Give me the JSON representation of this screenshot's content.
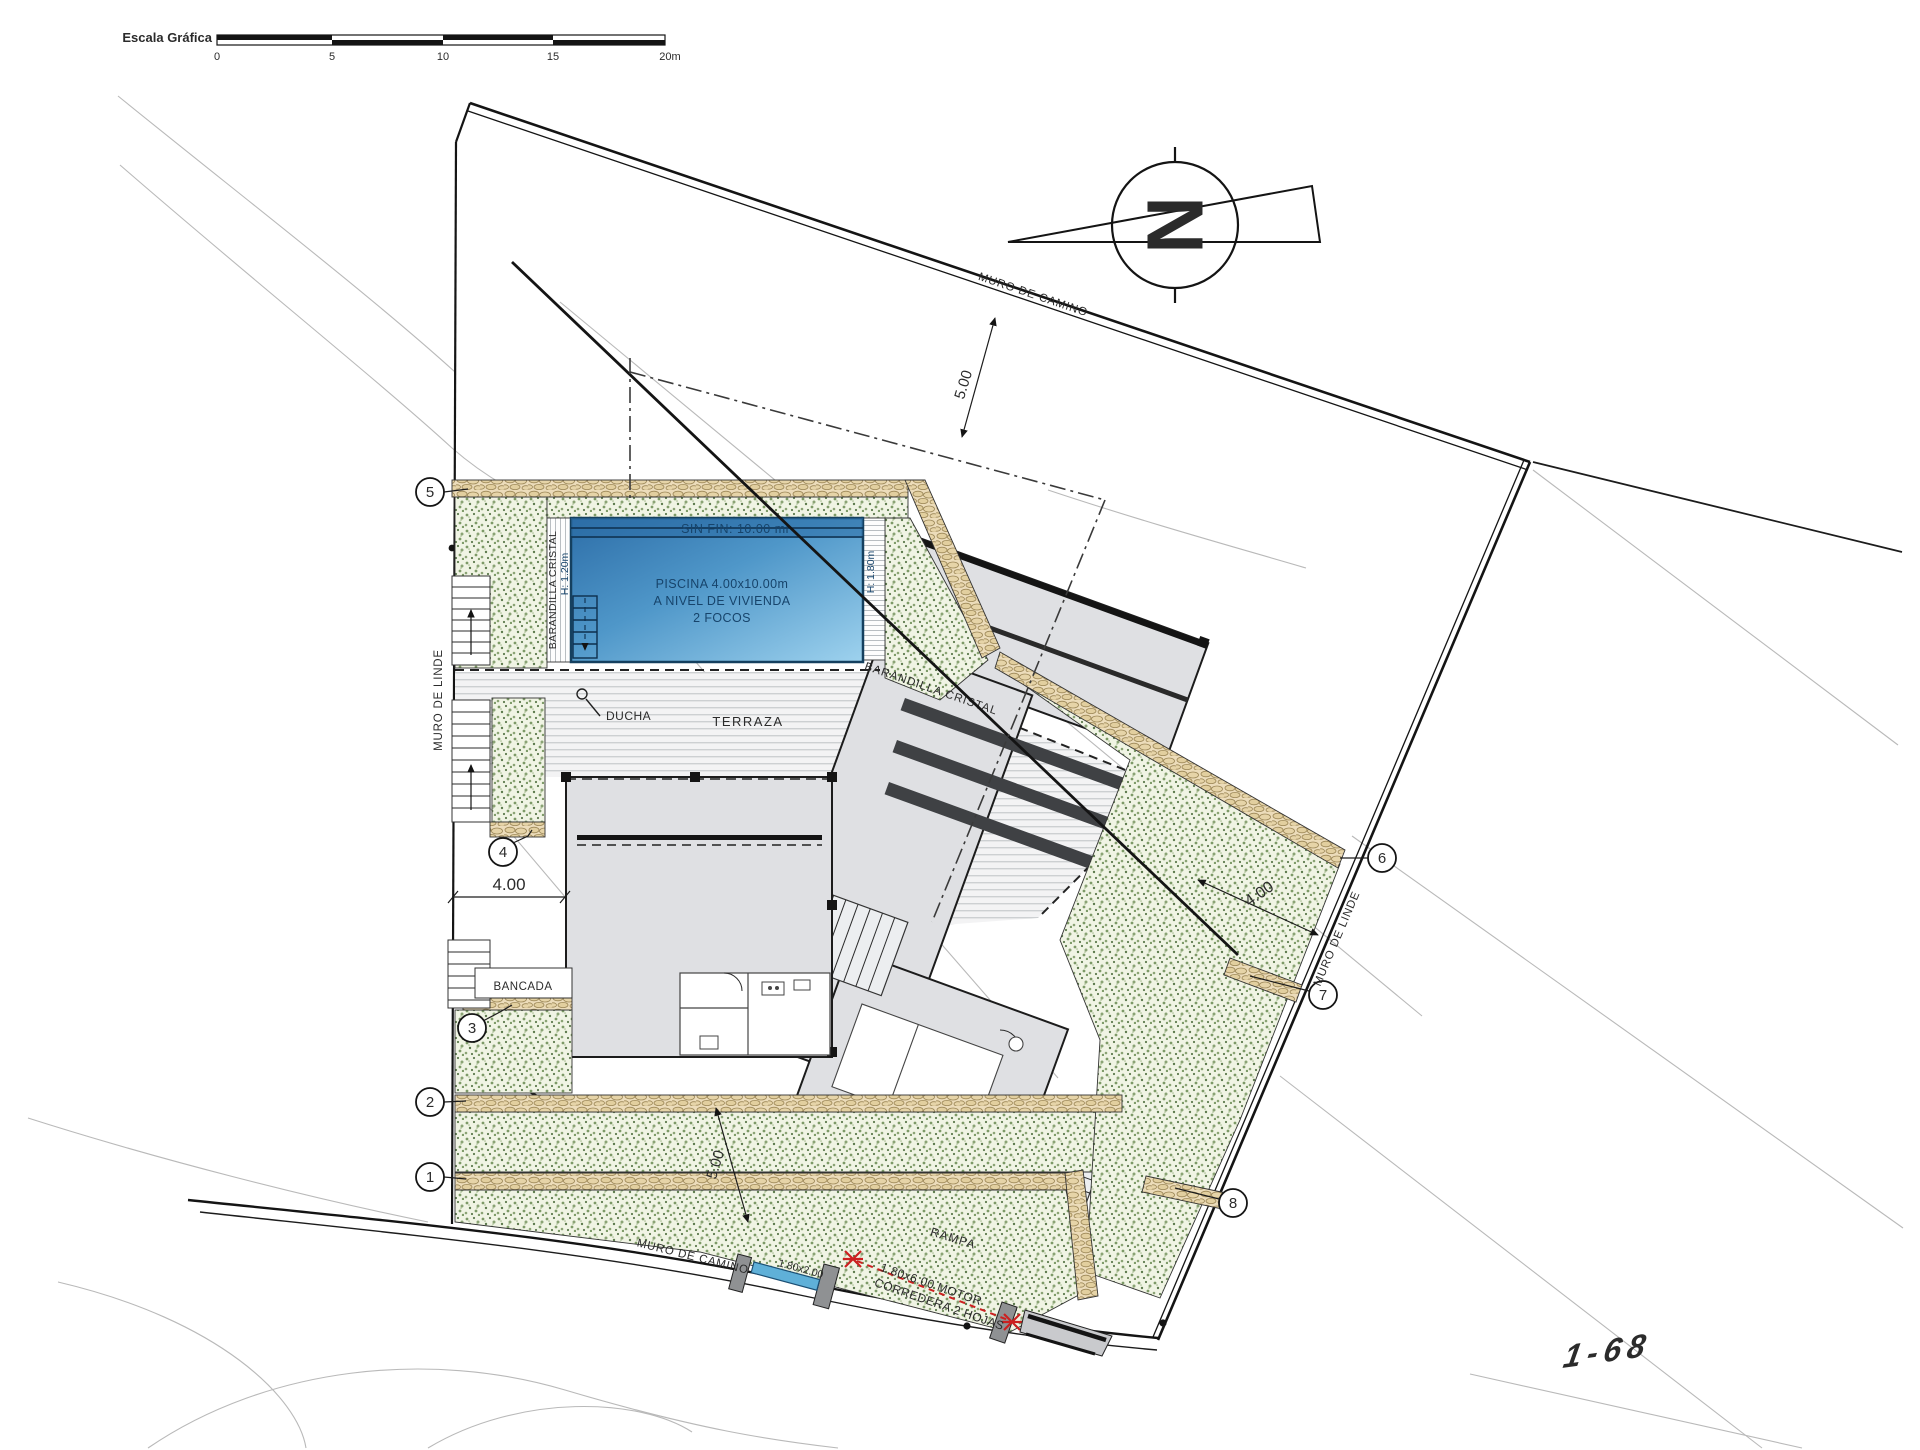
{
  "scalebar": {
    "title": "Escala Gráfica",
    "t0": "0",
    "t1": "5",
    "t2": "10",
    "t3": "15",
    "t4": "20m"
  },
  "north": {
    "letter": "N"
  },
  "boundaries": {
    "muro_camino_top": "MURO DE CAMINO",
    "muro_camino_bottom": "MURO DE CAMINO",
    "muro_linde_left": "MURO DE LINDE",
    "muro_linde_right": "MURO DE LINDE"
  },
  "dimensions": {
    "setback_top": "5.00",
    "setback_bottom": "5.00",
    "setback_left": "4.00",
    "setback_right": "4.00"
  },
  "pool": {
    "edge": "SIN FIN: 10.00 ml",
    "line1": "PISCINA 4.00x10.00m",
    "line2": "A NIVEL DE VIVIENDA",
    "line3": "2 FOCOS",
    "rail_left": "BARANDILLA CRISTAL",
    "rail_left_h": "H: 1.20m",
    "rail_right_h": "H: 1.80m",
    "rail_diag": "BARANDILLA CRISTAL",
    "shower": "DUCHA"
  },
  "areas": {
    "terrace": "TERRAZA",
    "bench": "BANCADA",
    "ramp": "RAMPA"
  },
  "gate": {
    "size": "1.80x2.00",
    "motor1": "1.80x6.00 MOTOR",
    "motor2": "CORREDERA 2 HOJAS"
  },
  "markers": [
    "1",
    "2",
    "3",
    "4",
    "5",
    "6",
    "7",
    "8"
  ],
  "watermark": "1-68",
  "colors": {
    "pool_dark": "#2d6ea8",
    "pool_light": "#9ed2ee",
    "wall_tan": "#ecdcba",
    "bed_green": "#f0f4e4",
    "accent_red": "#cc2020",
    "gate_blue": "#5fb0d8"
  }
}
